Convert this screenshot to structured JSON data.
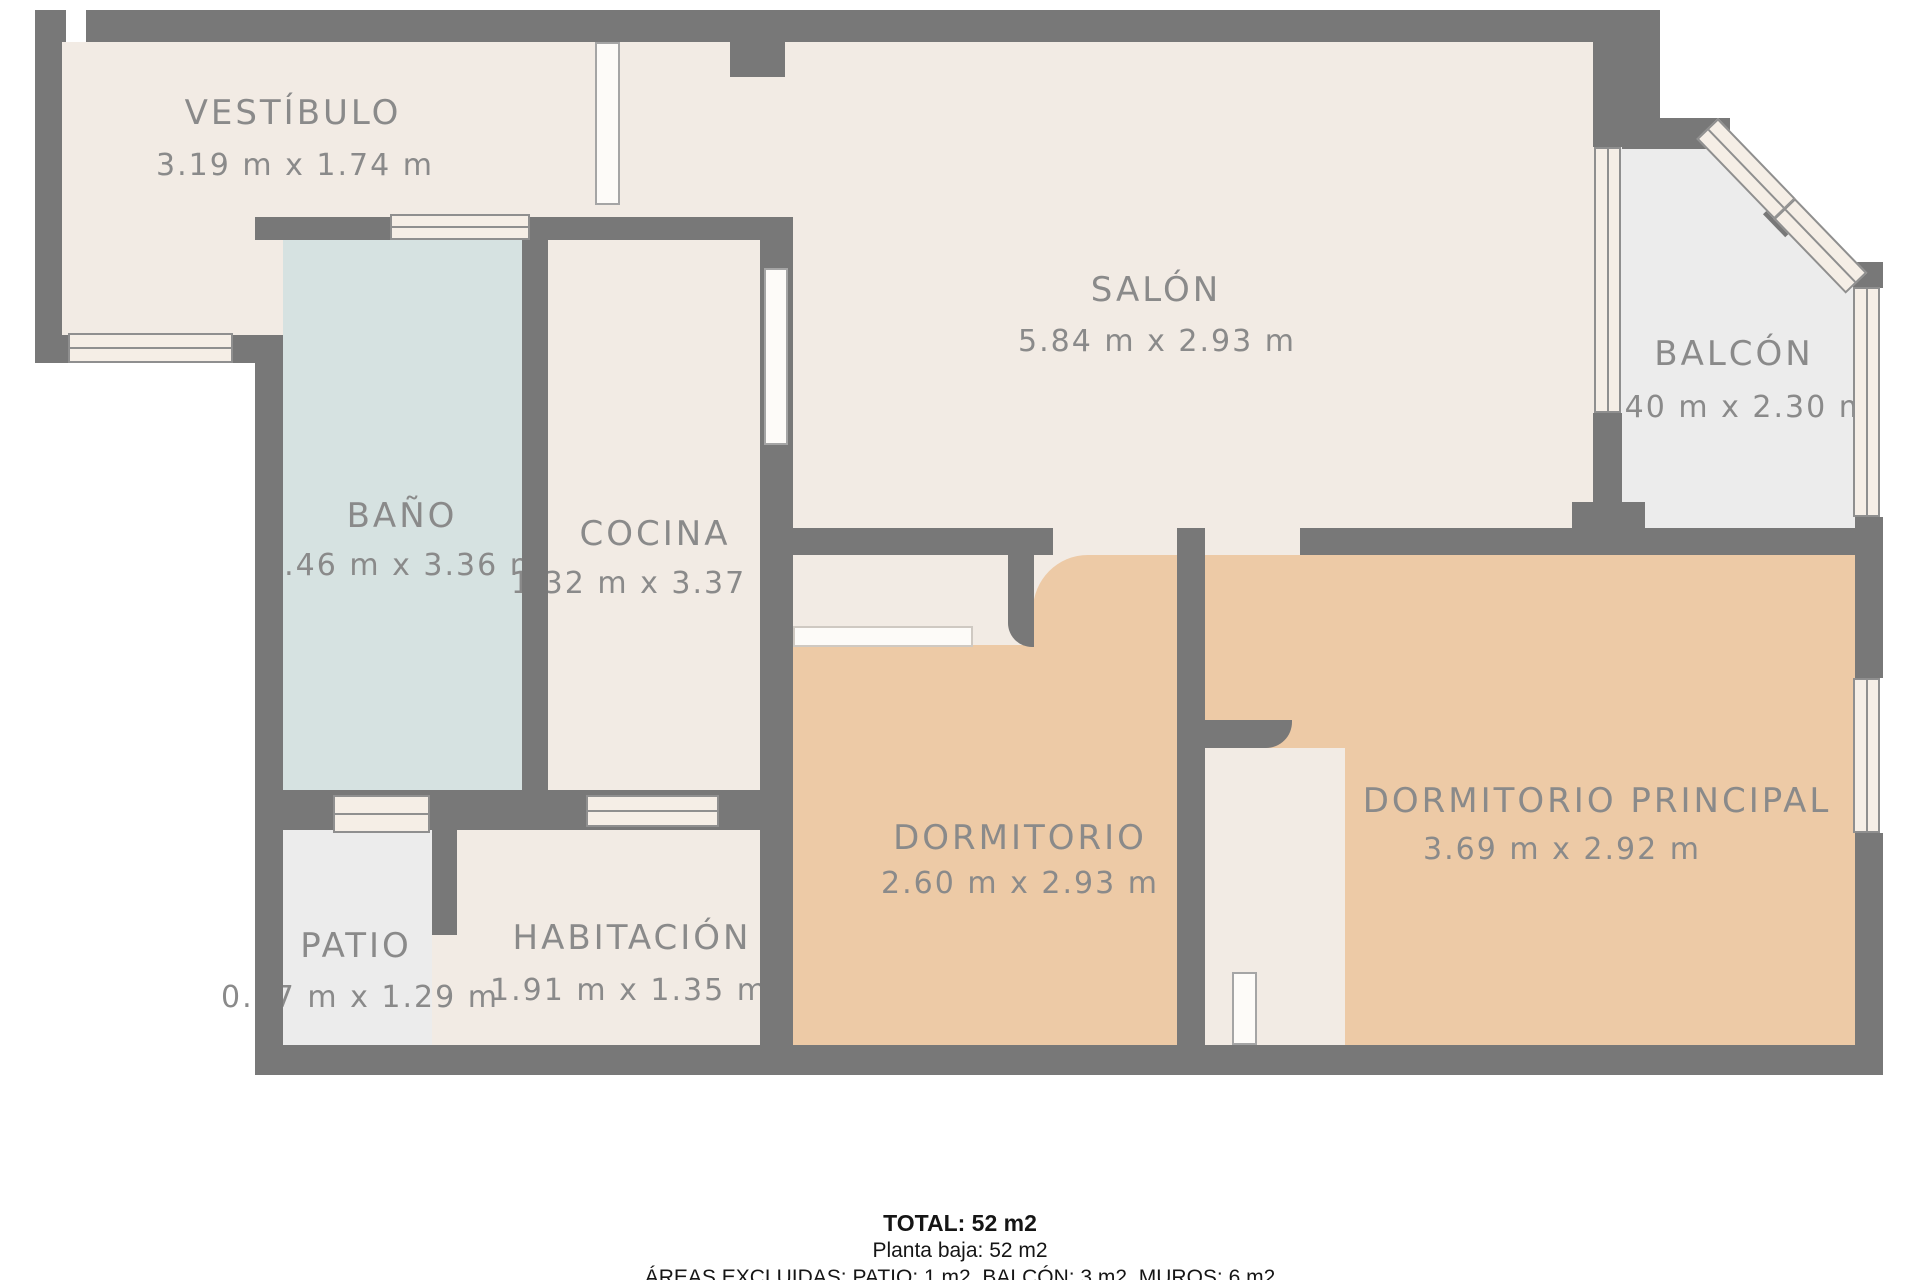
{
  "plan_type": "floor-plan",
  "rooms": [
    {
      "id": "vestibulo",
      "name": "VESTÍBULO",
      "dimensions": "3.19 m x 1.74 m"
    },
    {
      "id": "bano",
      "name": "BAÑO",
      "dimensions": "1.46 m x 3.36 m"
    },
    {
      "id": "cocina",
      "name": "COCINA",
      "dimensions": "1.32 m x 3.37 m"
    },
    {
      "id": "salon",
      "name": "SALÓN",
      "dimensions": "5.84 m x 2.93 m"
    },
    {
      "id": "balcon",
      "name": "BALCÓN",
      "dimensions": "1.40 m x 2.30 m"
    },
    {
      "id": "dormitorio",
      "name": "DORMITORIO",
      "dimensions": "2.60 m x 2.93 m"
    },
    {
      "id": "dormitorio_principal",
      "name": "DORMITORIO PRINCIPAL",
      "dimensions": "3.69 m x 2.92 m"
    },
    {
      "id": "patio",
      "name": "PATIO",
      "dimensions": "0.77 m x 1.29 m"
    },
    {
      "id": "habitacion",
      "name": "HABITACIÓN",
      "dimensions": "1.91 m x 1.35 m"
    }
  ],
  "summary": {
    "total": "TOTAL: 52 m2",
    "floor": "Planta baja: 52 m2",
    "excluded": "ÁREAS EXCLUIDAS: PATIO: 1 m2, BALCÓN: 3 m2, MUROS: 6 m2"
  },
  "colors": {
    "wall": "#787878",
    "cream": "#f2ebe4",
    "bath": "#d6e2e1",
    "bedroom": "#edcaa6",
    "terrace": "#ececec",
    "winfill": "#f5eee6",
    "ink": "#8a8a8a"
  }
}
